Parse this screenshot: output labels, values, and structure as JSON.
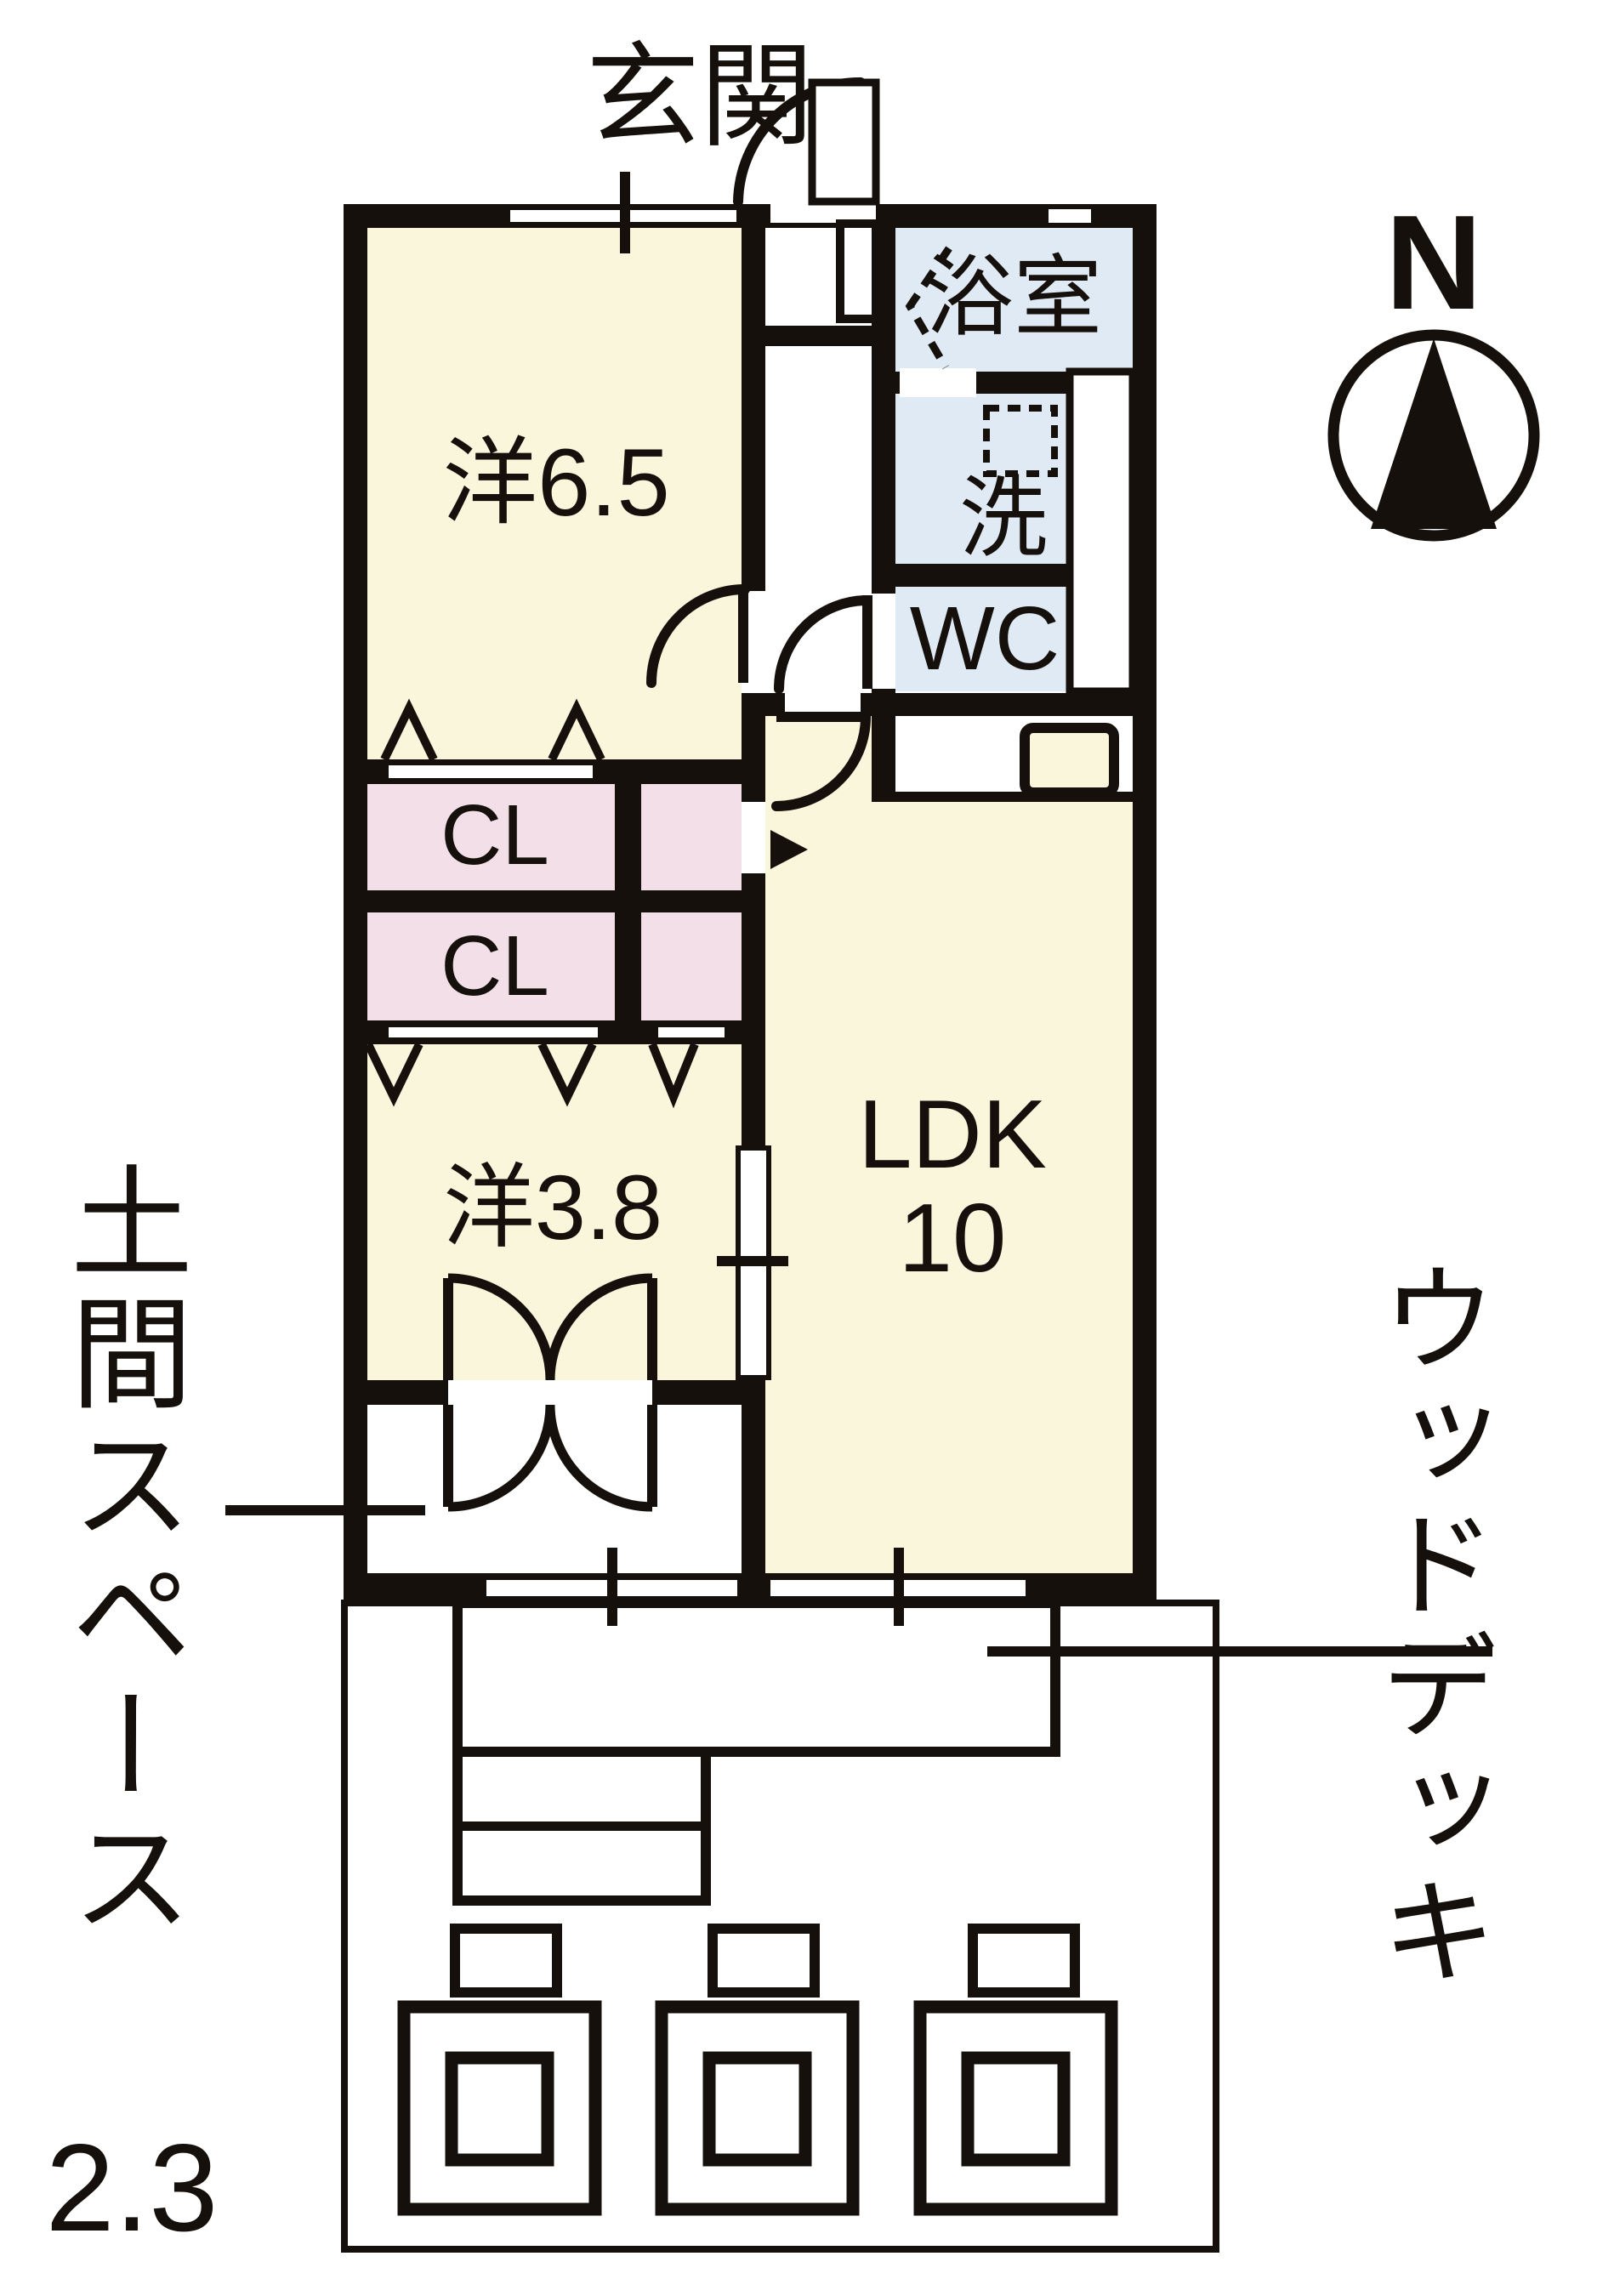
{
  "plan": {
    "compass": {
      "north_label": "N"
    },
    "entrance": {
      "label": "玄関"
    },
    "rooms": {
      "western_6_5": {
        "label": "洋6.5"
      },
      "bathroom": {
        "label": "浴室"
      },
      "laundry": {
        "label": "洗"
      },
      "toilet": {
        "label": "WC"
      },
      "closet_upper": {
        "label": "CL"
      },
      "closet_lower": {
        "label": "CL"
      },
      "western_3_8": {
        "label": "洋3.8"
      },
      "ldk": {
        "label": "LDK",
        "size": "10"
      },
      "doma": {
        "label": "土間スペース",
        "size": "2.3"
      },
      "wood_deck": {
        "label": "ウッドデッキ"
      }
    },
    "colors": {
      "wall": "#15100b",
      "room_cream": "#faf6dc",
      "wet_blue": "#dfeaf4",
      "closet_pink": "#f2dfe8",
      "background": "#ffffff"
    }
  }
}
